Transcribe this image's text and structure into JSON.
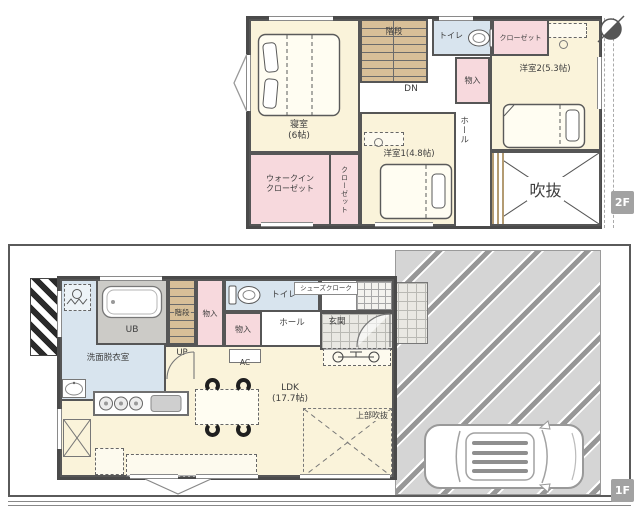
{
  "palette": {
    "room_cream": "#faf3da",
    "closet_pink": "#f7d9dd",
    "wet_blue": "#d8e4ee",
    "stair_tan": "#d8bf98",
    "ub_gray": "#cccbc7",
    "wall": "#4a4a4a",
    "parking_gray": "#d5d5d5",
    "badge_gray": "#a2a2a2"
  },
  "floor2": {
    "badge": "2F",
    "bedroom": {
      "name": "寝室",
      "size": "(6帖)"
    },
    "wic": {
      "line1": "ウォークイン",
      "line2": "クローゼット"
    },
    "closet_side": {
      "label": "クローゼット"
    },
    "stairs": {
      "label": "階段",
      "dn": "DN"
    },
    "toilet": {
      "label": "トイレ"
    },
    "closet_top": {
      "label": "クローゼット"
    },
    "storage": {
      "label": "物入"
    },
    "hall": {
      "label": "ホール"
    },
    "room2": {
      "label": "洋室2(5.3帖)"
    },
    "room1": {
      "label": "洋室1(4.8帖)"
    },
    "void": {
      "label": "吹抜"
    }
  },
  "floor1": {
    "badge": "1F",
    "ub": {
      "label": "UB"
    },
    "stairs": {
      "label": "階段",
      "up": "UP"
    },
    "storage_a": {
      "label": "物入"
    },
    "storage_b": {
      "label": "物入"
    },
    "toilet": {
      "label": "トイレ"
    },
    "shoes": {
      "label": "シューズクローク"
    },
    "hall": {
      "label": "ホール"
    },
    "genkan": {
      "label": "玄関"
    },
    "ac": {
      "label": "AC"
    },
    "washroom": {
      "label": "洗面脱衣室"
    },
    "ldk": {
      "name": "LDK",
      "size": "(17.7帖)"
    },
    "void_upper": {
      "label": "上部吹抜"
    }
  }
}
